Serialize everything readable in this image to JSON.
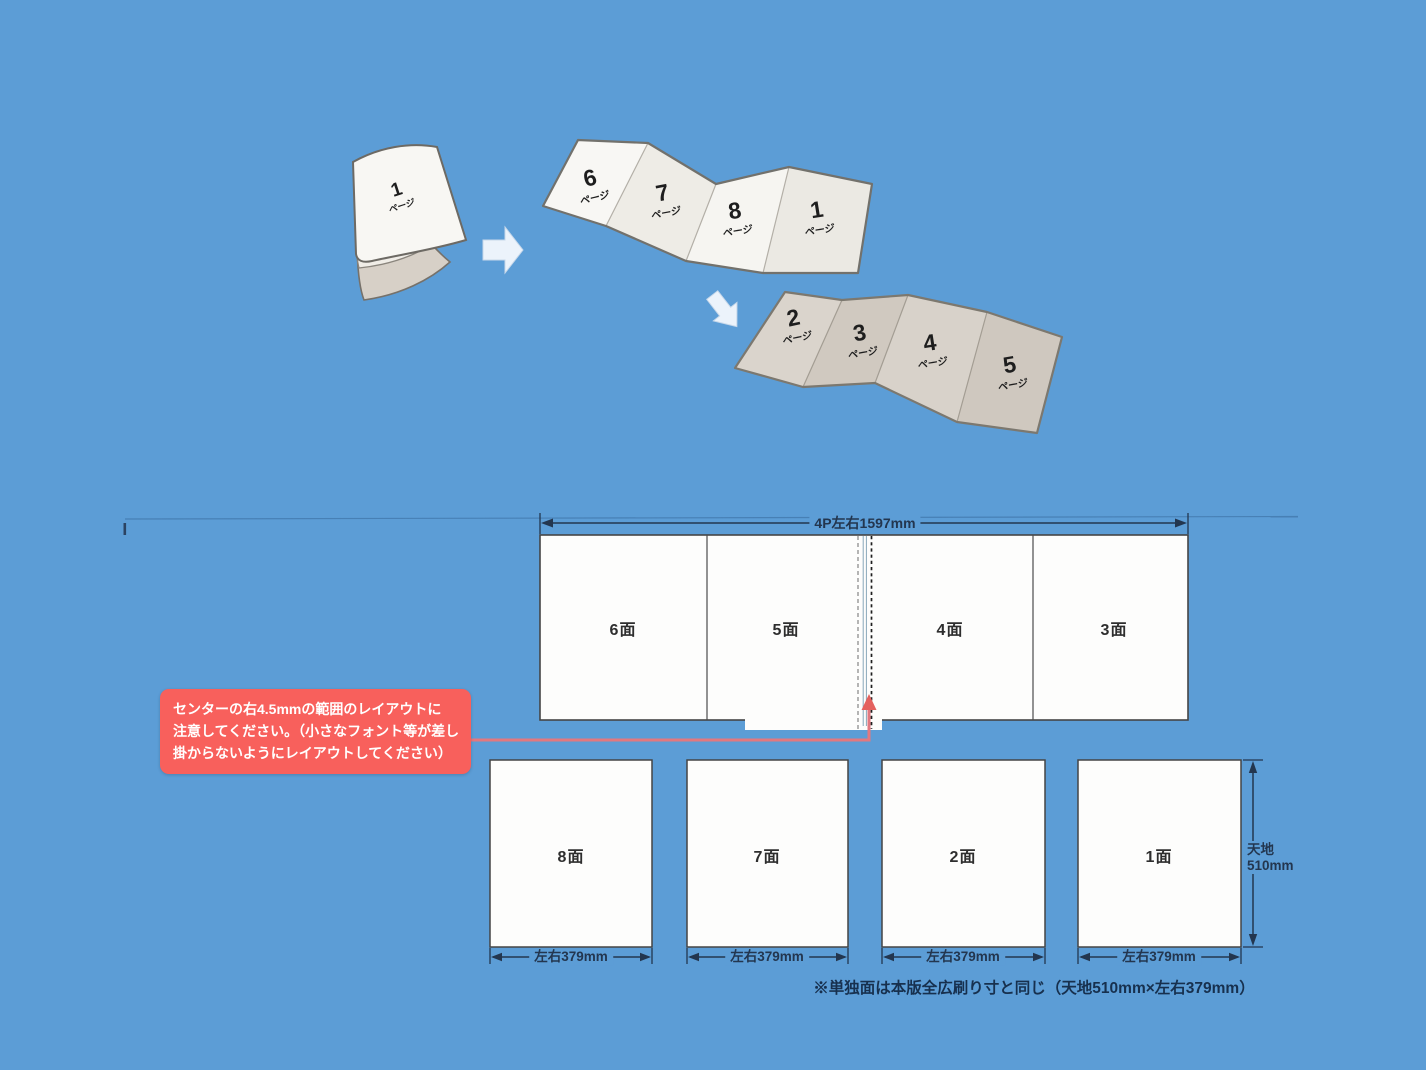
{
  "colors": {
    "background": "#5C9DD6",
    "callout_bg": "#F8605C",
    "callout_text": "#FFFFFF",
    "connector_pink": "#E3787F",
    "dimension_navy": "#23364F",
    "panel_fill": "#FDFDFC",
    "panel_border": "#454545",
    "paper_white": "#F7F6F3",
    "paper_tan": "#D9D3CB"
  },
  "illustration": {
    "page_unit": "ページ",
    "booklet_page": "1",
    "top_accordion_pages": [
      "6",
      "7",
      "8",
      "1"
    ],
    "bottom_accordion_pages": [
      "2",
      "3",
      "4",
      "5"
    ]
  },
  "diagram": {
    "top_dimension": "4P左右1597mm",
    "top_row_panels": [
      "6面",
      "5面",
      "4面",
      "3面"
    ],
    "bottom_row_panels": [
      "8面",
      "7面",
      "2面",
      "1面"
    ],
    "panel_width_label": "左右379mm",
    "panel_height_label_line1": "天地",
    "panel_height_label_line2": "510mm",
    "note": "※単独面は本版全広刷り寸と同じ（天地510mm×左右379mm）",
    "callout_lines": [
      "センターの右4.5mmの範囲のレイアウトに",
      "注意してください。（小さなフォント等が差し",
      "掛からないようにレイアウトしてください）"
    ]
  }
}
